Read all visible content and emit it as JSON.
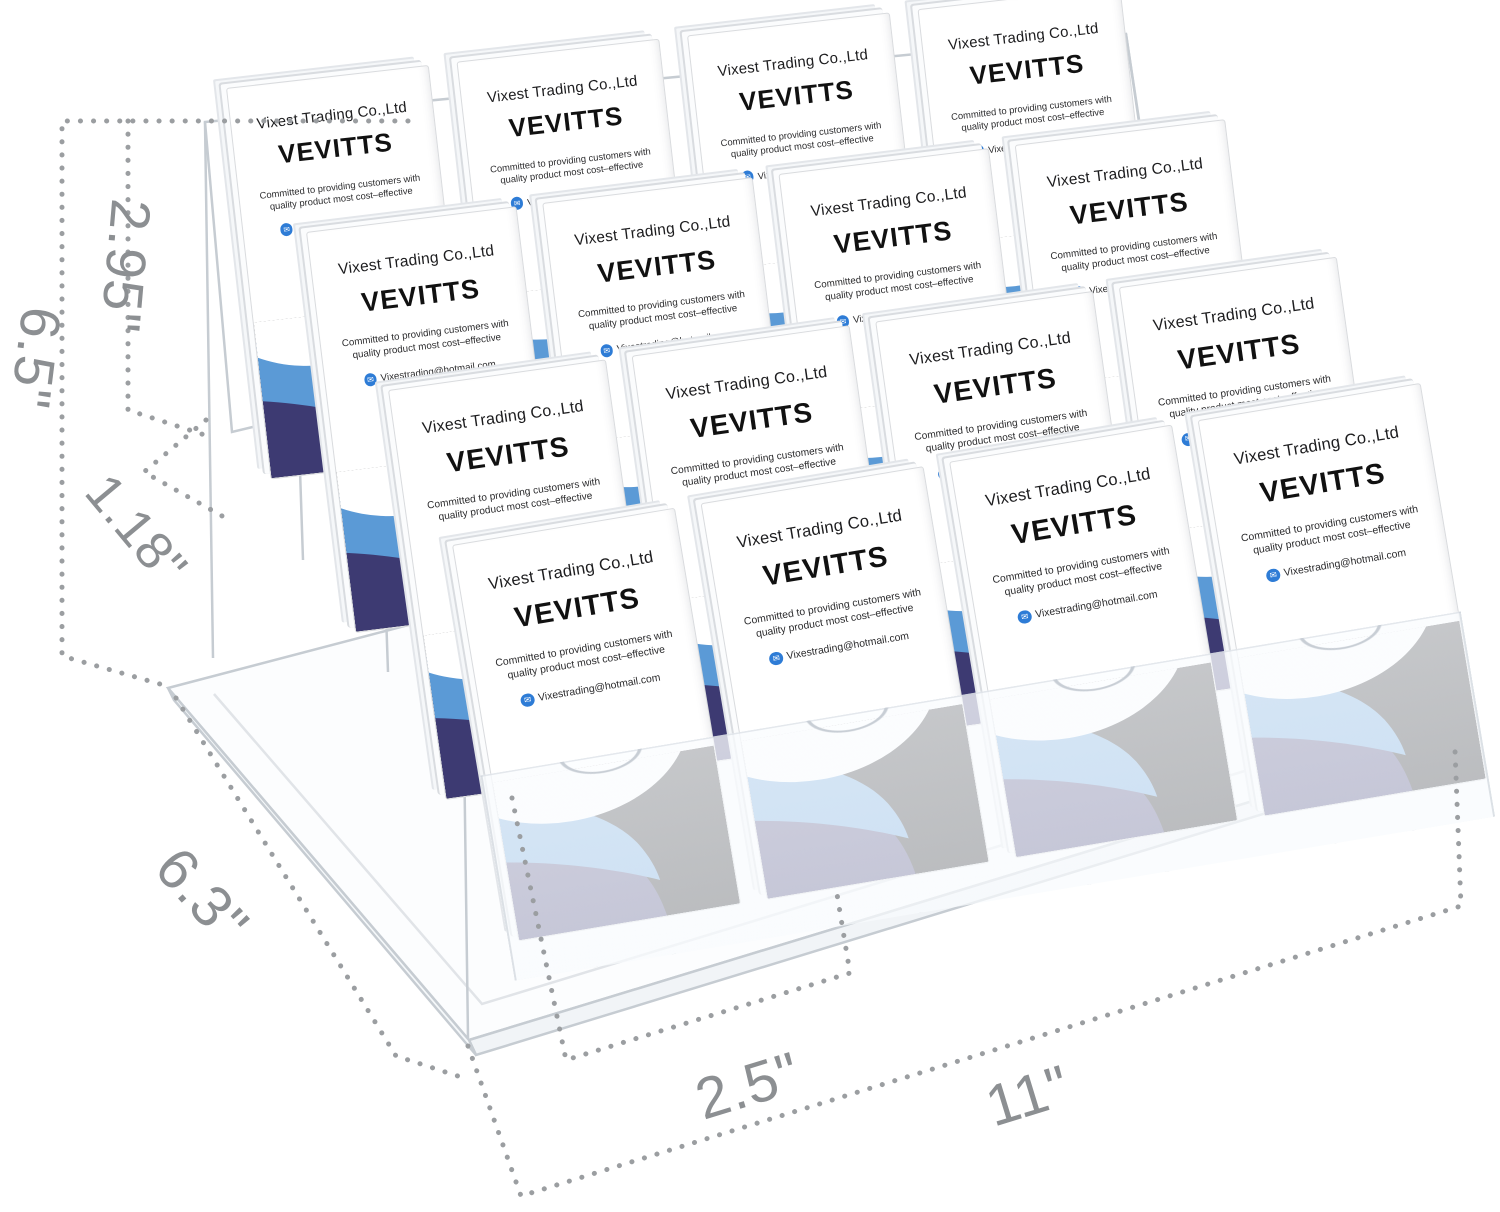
{
  "product": {
    "name": "acrylic multi-tier business card holder",
    "grid": {
      "rows": 4,
      "columns": 4,
      "total_slots": 16
    },
    "card": {
      "company": "Vixest Trading Co.,Ltd",
      "brand": "VEVITTS",
      "tagline_line1": "Committed to providing customers with",
      "tagline_line2": "quality product most cost–effective",
      "email": "Vixestrading@hotmail.com",
      "email_icon_glyph": "✉"
    }
  },
  "dimension_labels": {
    "back_panel_height": "2.95\"",
    "total_height": "6.5\"",
    "tier_step_height": "1.18\"",
    "depth": "6.3\"",
    "slot_width": "2.5\"",
    "total_width": "11\""
  },
  "colors": {
    "card_wave_light_blue": "#5b9ad6",
    "card_wave_indigo": "#3d3a72",
    "card_wave_black": "#141418",
    "email_icon_blue": "#2e7cd6",
    "dimension_line_gray": "#9b9ea1",
    "dimension_label_gray": "#8c8f92",
    "acrylic_edge_gray": "#c6ccd2"
  }
}
